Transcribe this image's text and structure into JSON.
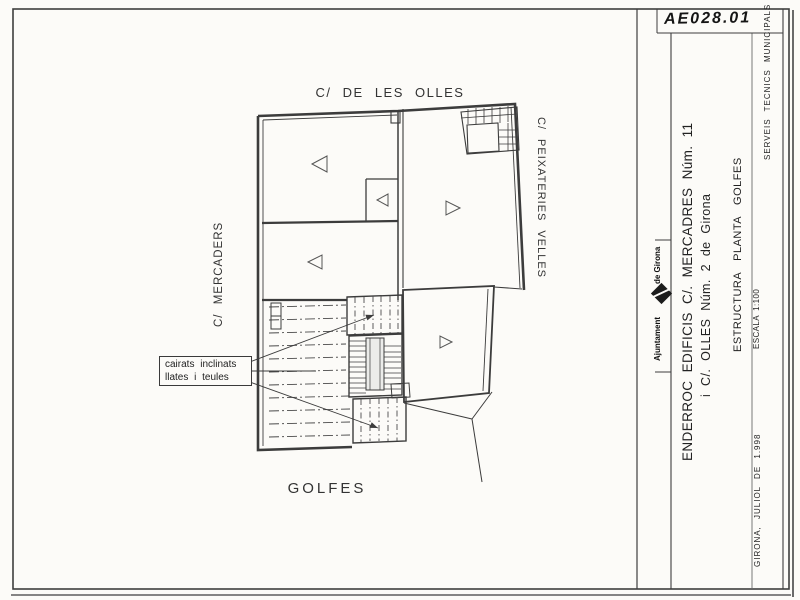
{
  "sheet": {
    "code": "AE028.01",
    "org_top": "de Girona",
    "org_bottom": "Ajuntament",
    "title_line1": "ENDERROC EDIFICIS C/. MERCADRES Núm. 11",
    "title_line2": "i C/. OLLES Núm. 2 de Girona",
    "subtitle": "ESTRUCTURA PLANTA GOLFES",
    "scale_label": "ESCALA 1:100",
    "department": "SERVEIS TECNICS MUNICIPALS",
    "date_place": "GIRONA, JULIOL DE 1.998"
  },
  "plan": {
    "street_top": "C/ DE LES OLLES",
    "street_left": "C/ MERCADERS",
    "street_right": "C/ PEIXATERIES VELLES",
    "area_label": "GOLFES",
    "annotation": {
      "line1": "cairats inclinats",
      "line2": "llates i teules"
    }
  },
  "colors": {
    "ink": "#3c3c3c",
    "paper": "#fcfbf8"
  }
}
